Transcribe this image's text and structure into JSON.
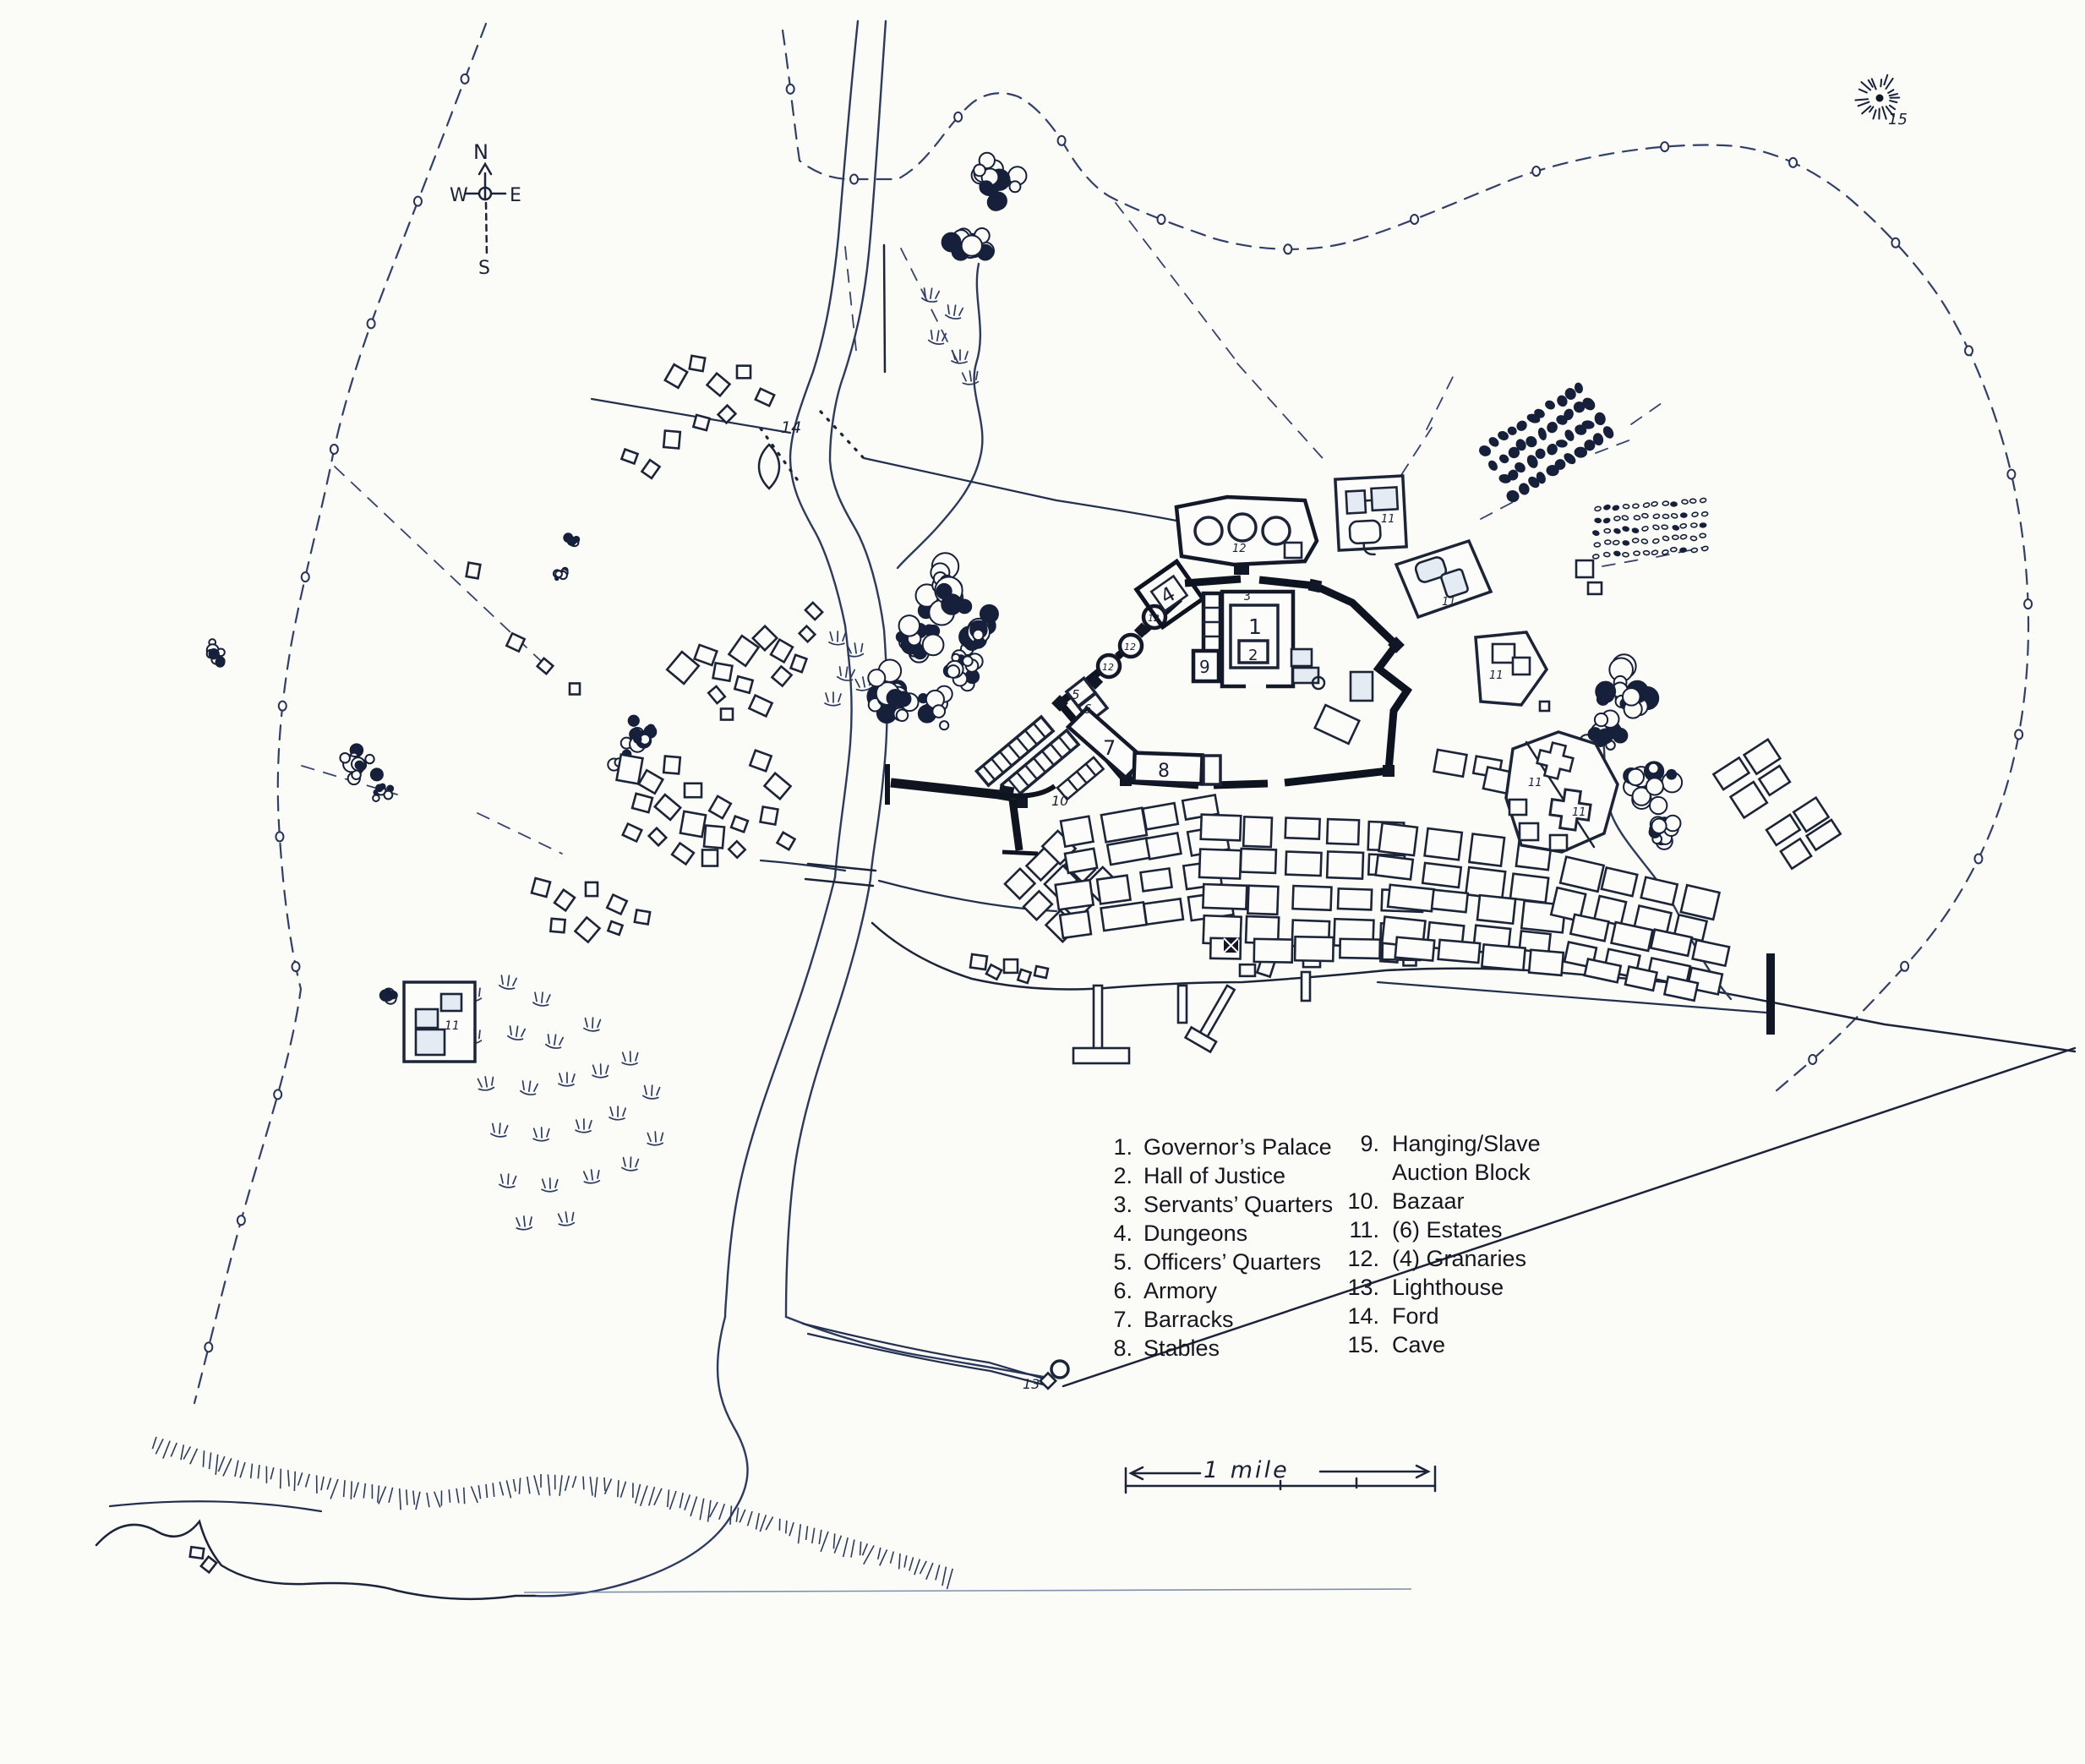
{
  "compass": {
    "n": "N",
    "e": "E",
    "w": "W",
    "s": "S"
  },
  "scale_bar": {
    "label": "1 mile"
  },
  "legend": {
    "col1": [
      {
        "num": "1.",
        "label": "Governor’s Palace"
      },
      {
        "num": "2.",
        "label": "Hall of Justice"
      },
      {
        "num": "3.",
        "label": "Servants’ Quarters"
      },
      {
        "num": "4.",
        "label": "Dungeons"
      },
      {
        "num": "5.",
        "label": "Officers’ Quarters"
      },
      {
        "num": "6.",
        "label": "Armory"
      },
      {
        "num": "7.",
        "label": "Barracks"
      },
      {
        "num": "8.",
        "label": "Stables"
      }
    ],
    "col2": [
      {
        "num": "9.",
        "label": "Hanging/Slave",
        "label2": "Auction Block"
      },
      {
        "num": "10.",
        "label": "Bazaar"
      },
      {
        "num": "11.",
        "label": "(6) Estates"
      },
      {
        "num": "12.",
        "label": "(4) Granaries"
      },
      {
        "num": "13.",
        "label": "Lighthouse"
      },
      {
        "num": "14.",
        "label": "Ford"
      },
      {
        "num": "15.",
        "label": "Cave"
      }
    ]
  },
  "markers": {
    "governors_palace": "1",
    "hall_of_justice": "2",
    "servants_quarters": "3",
    "dungeons": "4",
    "officers_quarters": "5",
    "armory": "6",
    "barracks": "7",
    "stables": "8",
    "auction_block": "9",
    "bazaar": "10",
    "estate": "11",
    "granary": "12",
    "lighthouse": "13",
    "ford": "14",
    "cave": "15"
  }
}
